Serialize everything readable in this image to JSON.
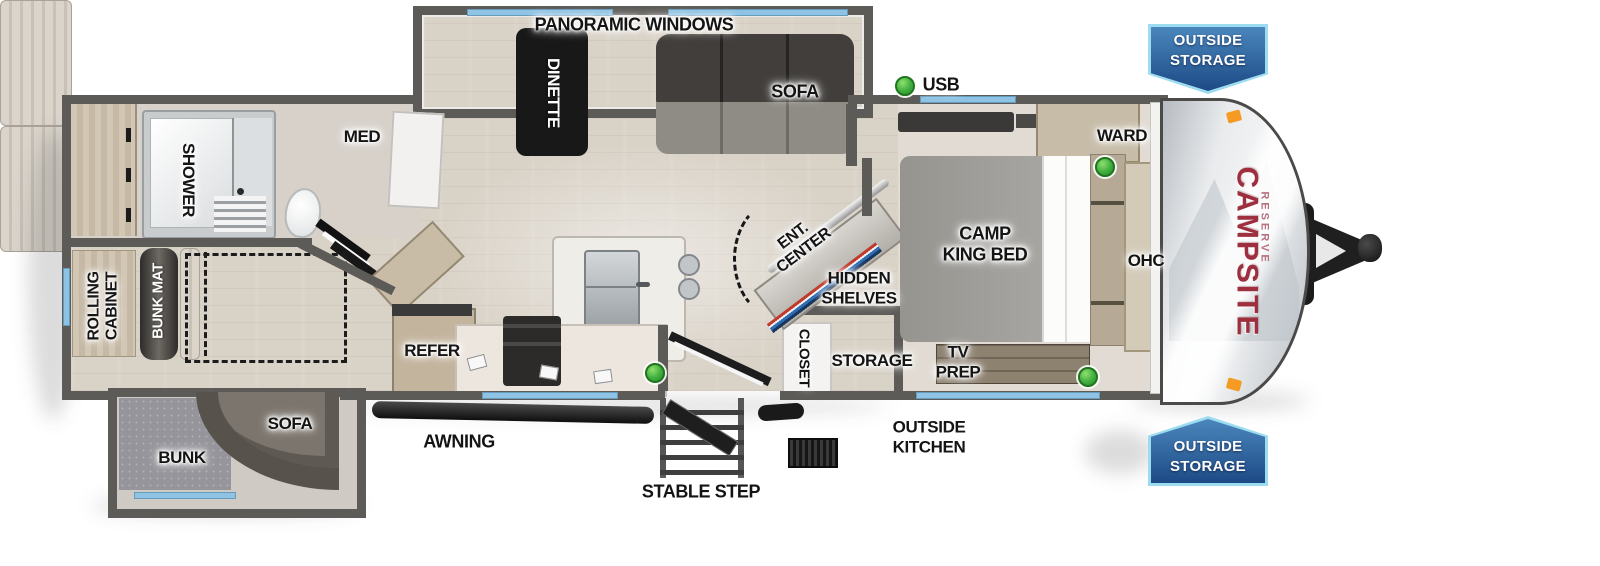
{
  "colors": {
    "accent-blue": "#8fc3e4",
    "brand-red": "#9e2f3f",
    "brand-red-light": "#b5717d",
    "usb-green": "#3fae3f",
    "badge-blue-light": "#4a86bc",
    "badge-blue-dark": "#1d4a86",
    "badge-border": "#9ddcf0"
  },
  "brand": {
    "name": "CAMPSITE",
    "series": "RESERVE"
  },
  "badges": {
    "top_right": {
      "line1": "OUTSIDE",
      "line2": "STORAGE"
    },
    "bottom_right": {
      "line1": "OUTSIDE",
      "line2": "STORAGE"
    }
  },
  "exterior": {
    "usb": "USB",
    "awning": "AWNING",
    "stable_step": "STABLE STEP",
    "outside_kitchen_line1": "OUTSIDE",
    "outside_kitchen_line2": "KITCHEN"
  },
  "rooms": {
    "slideout_top": {
      "panoramic": "PANORAMIC WINDOWS",
      "dinette": "DINETTE",
      "sofa": "SOFA"
    },
    "bath": {
      "shower": "SHOWER",
      "med": "MED"
    },
    "bunk_room": {
      "rolling_line1": "ROLLING",
      "rolling_line2": "CABINET",
      "bunk_mat": "BUNK MAT"
    },
    "slideout_bottom": {
      "sofa": "SOFA",
      "bunk": "BUNK"
    },
    "kitchen": {
      "refer": "REFER"
    },
    "living": {
      "ent_line1": "ENT.",
      "ent_line2": "CENTER",
      "hidden_line1": "HIDDEN",
      "hidden_line2": "SHELVES"
    },
    "entry": {
      "closet": "CLOSET",
      "storage": "STORAGE"
    },
    "bedroom": {
      "bed_line1": "CAMP",
      "bed_line2": "KING BED",
      "ward": "WARD",
      "ohc": "OHC",
      "tv_line1": "TV",
      "tv_line2": "PREP"
    }
  }
}
